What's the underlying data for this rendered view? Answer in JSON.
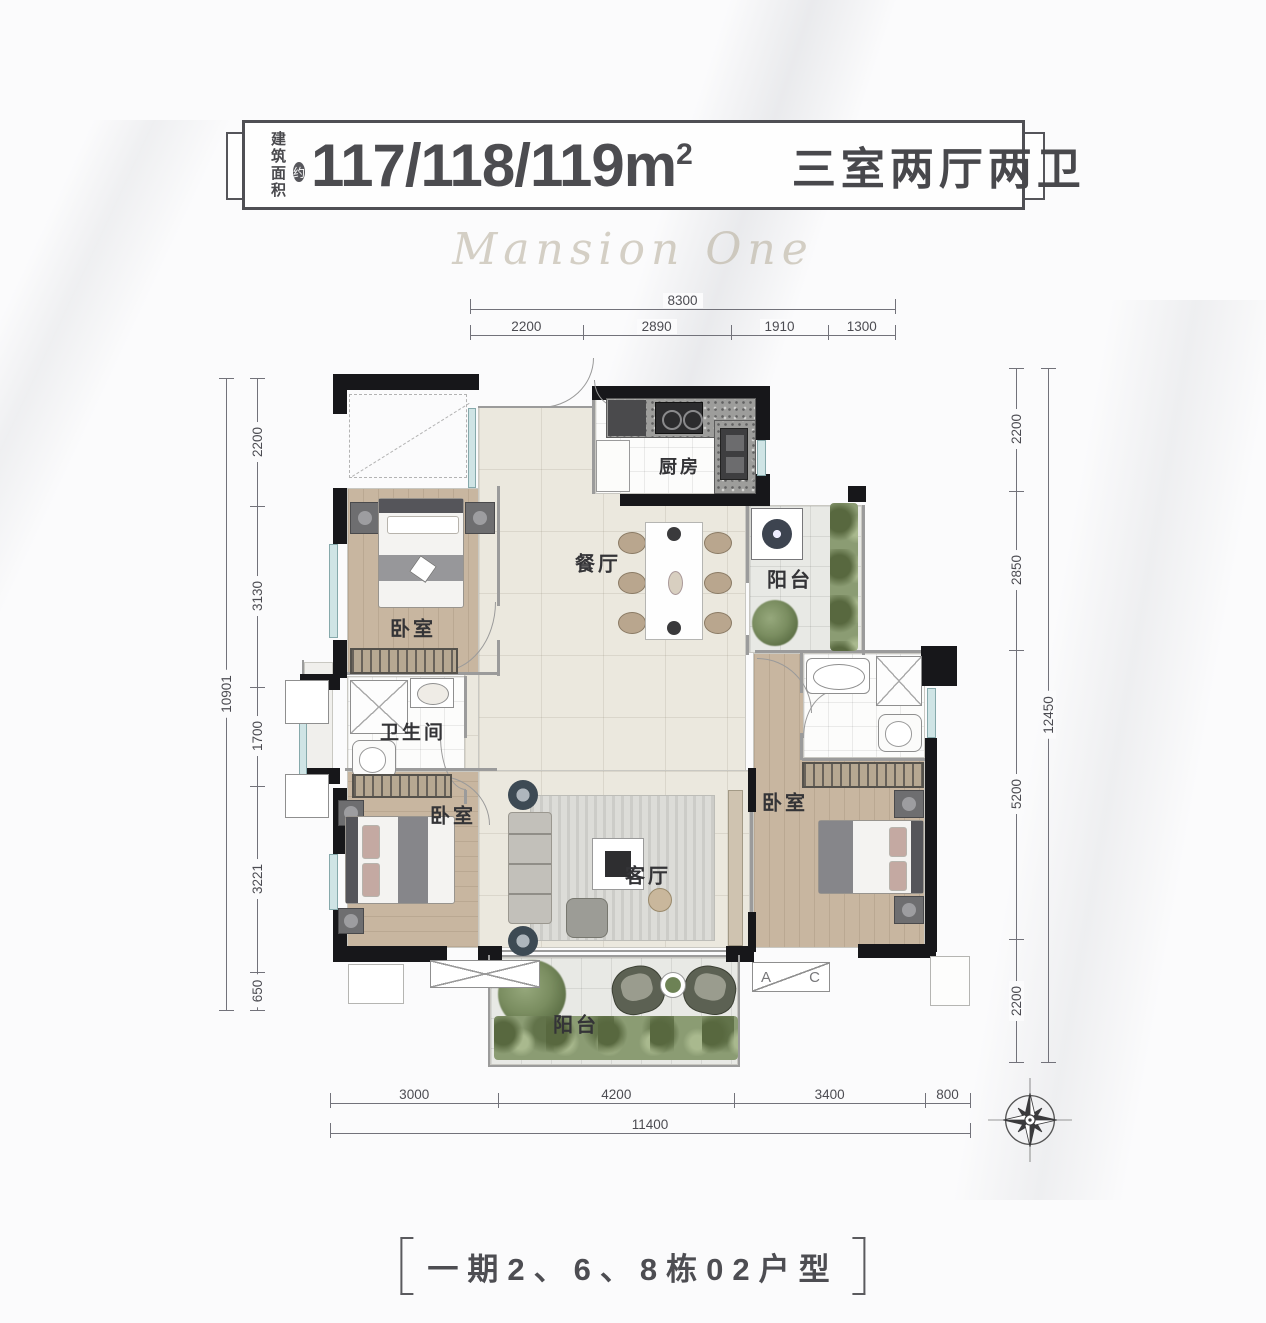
{
  "header": {
    "area_label_line1": "建筑",
    "area_label_line2": "面积",
    "approx_badge": "约",
    "area_value": "117/118/119m",
    "area_sup": "2",
    "layout_text": "三室两厅两卫"
  },
  "watermark": "Mansion One",
  "rooms": {
    "kitchen": "厨房",
    "dining": "餐厅",
    "balcony_top": "阳台",
    "balcony_bottom": "阳台",
    "bedroom_top_left": "卧室",
    "bedroom_bottom_left": "卧室",
    "bedroom_right": "卧室",
    "bathroom": "卫生间",
    "living": "客厅",
    "ac_letter_a": "A",
    "ac_letter_c": "C"
  },
  "dimensions": {
    "top": {
      "total": "8300",
      "segments": [
        "2200",
        "2890",
        "1910",
        "1300"
      ]
    },
    "left": {
      "total": "10901",
      "segments": [
        "2200",
        "3130",
        "1700",
        "3221",
        "650"
      ]
    },
    "right": {
      "total": "12450",
      "segments": [
        "2200",
        "2850",
        "5200",
        "2200"
      ]
    },
    "bottom": {
      "total": "11400",
      "segments": [
        "3000",
        "4200",
        "3400",
        "800"
      ]
    }
  },
  "footer": {
    "title": "一期2、6、8栋02户型"
  },
  "colors": {
    "wall": "#17171a",
    "wood_floor": "#c8b6a0",
    "tile_floor": "#ebe8de",
    "window": "#cfe4e5",
    "plant": "#7a8d60",
    "text": "#4c4c50"
  }
}
